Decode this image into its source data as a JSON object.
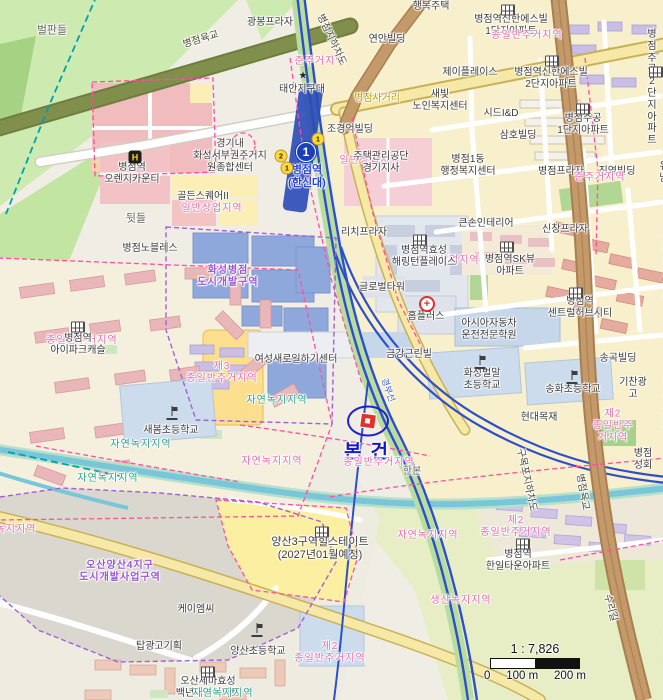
{
  "map": {
    "subject": {
      "label": "본건"
    },
    "station": {
      "line": "1",
      "name": "병점역",
      "name_sub": "(한신대)"
    },
    "scale": {
      "ratio": "1 : 7,826",
      "ticks": [
        "0",
        "100 m",
        "200 m"
      ]
    },
    "colors": {
      "subject_blue": "#2121c9",
      "subject_red": "#e43028",
      "zone_pink": "#e66cab",
      "zone_green": "#2ba187",
      "zone_purple": "#9a55d2",
      "railway_blue": "#2d4fc8",
      "road_brown": "#c59a6b",
      "road_olive": "#808f4c",
      "field_green": "#cdebb0",
      "urban_yellow": "#f8f0cc",
      "water": "#79c6db",
      "line1_badge": "#1b3fb5"
    },
    "labels": [
      {
        "t": "벌판들",
        "x": 52,
        "y": 31,
        "c": "g",
        "s": 11
      },
      {
        "t": "광봉프라자",
        "x": 270,
        "y": 23,
        "c": "b"
      },
      {
        "t": "행복주택",
        "x": 431,
        "y": 7,
        "c": "b"
      },
      {
        "t": "병점역신한에스빌\n1단지아파트",
        "x": 511,
        "y": 26,
        "c": "b"
      },
      {
        "t": "종일반주거지역",
        "x": 527,
        "y": 36,
        "c": "zp"
      },
      {
        "t": "연안빌딩",
        "x": 387,
        "y": 40,
        "c": "b"
      },
      {
        "t": "준주거지역",
        "x": 320,
        "y": 62,
        "c": "zp"
      },
      {
        "t": "준주거지역",
        "x": 668,
        "y": 59,
        "c": "zp"
      },
      {
        "t": "제이플레이스",
        "x": 470,
        "y": 73,
        "c": "b"
      },
      {
        "t": "병점역신한에스빌\n2단지아파트",
        "x": 551,
        "y": 79,
        "c": "b"
      },
      {
        "t": "병점주공\n2단지아파트",
        "x": 652,
        "y": 88,
        "c": "b"
      },
      {
        "t": "새빛\n노인복지센터",
        "x": 440,
        "y": 101,
        "c": "b"
      },
      {
        "t": "시드I&D",
        "x": 501,
        "y": 114,
        "c": "b"
      },
      {
        "t": "삼호빌딩",
        "x": 518,
        "y": 136,
        "c": "b"
      },
      {
        "t": "병점주공\n1단지아파트",
        "x": 583,
        "y": 125,
        "c": "b"
      },
      {
        "t": "태안지구대",
        "x": 302,
        "y": 90,
        "c": "b"
      },
      {
        "t": "병점사거리",
        "x": 377,
        "y": 99,
        "c": "yj"
      },
      {
        "t": "조경억빌딩",
        "x": 350,
        "y": 130,
        "c": "b"
      },
      {
        "t": "경기내\n화성서부권주거지\n원종합센터",
        "x": 230,
        "y": 156,
        "c": "b"
      },
      {
        "t": "병점역\n오렌지카운티",
        "x": 132,
        "y": 174,
        "c": "b"
      },
      {
        "t": "일반상업지역",
        "x": 370,
        "y": 161,
        "c": "zp"
      },
      {
        "t": "주택관리공단\n경기지사",
        "x": 381,
        "y": 163,
        "c": "b"
      },
      {
        "t": "병점1동\n행정복지센터",
        "x": 468,
        "y": 166,
        "c": "b"
      },
      {
        "t": "병점프라자",
        "x": 561,
        "y": 172,
        "c": "b"
      },
      {
        "t": "진영빌딩",
        "x": 617,
        "y": 172,
        "c": "b"
      },
      {
        "t": "준주거지역",
        "x": 600,
        "y": 178,
        "c": "zp"
      },
      {
        "t": "유남",
        "x": 664,
        "y": 173,
        "c": "b"
      },
      {
        "t": "골든스퀘어II",
        "x": 203,
        "y": 197,
        "c": "b"
      },
      {
        "t": "일반상업지역",
        "x": 212,
        "y": 209,
        "c": "zp"
      },
      {
        "t": "뒷들",
        "x": 136,
        "y": 219,
        "c": "g",
        "s": 11
      },
      {
        "t": "리치프라자",
        "x": 364,
        "y": 233,
        "c": "b"
      },
      {
        "t": "큰손인테리어",
        "x": 486,
        "y": 224,
        "c": "b"
      },
      {
        "t": "신창프라자",
        "x": 565,
        "y": 230,
        "c": "b"
      },
      {
        "t": "병점노블레스",
        "x": 150,
        "y": 249,
        "c": "b"
      },
      {
        "t": "제3\n종일반주거지역",
        "x": 672,
        "y": 233,
        "c": "zp"
      },
      {
        "t": "자연녹지지역",
        "x": 668,
        "y": 271,
        "c": "zg"
      },
      {
        "t": "일반상업지역",
        "x": 449,
        "y": 261,
        "c": "zp"
      },
      {
        "t": "병점역효성\n해링턴플레이스",
        "x": 424,
        "y": 257,
        "c": "b"
      },
      {
        "t": "병점역SK뷰\n아파트",
        "x": 510,
        "y": 266,
        "c": "b"
      },
      {
        "t": "남수원",
        "x": 668,
        "y": 262,
        "c": "b"
      },
      {
        "t": "글로벌타워",
        "x": 382,
        "y": 288,
        "c": "b"
      },
      {
        "t": "병점역\n센트럴허브시티",
        "x": 580,
        "y": 308,
        "c": "b"
      },
      {
        "t": "홈플러스",
        "x": 426,
        "y": 317,
        "c": "b"
      },
      {
        "t": "아시아자동차\n운전전문학원",
        "x": 489,
        "y": 330,
        "c": "b"
      },
      {
        "t": "송곡빌딩",
        "x": 618,
        "y": 359,
        "c": "b"
      },
      {
        "t": "기찬광고",
        "x": 633,
        "y": 389,
        "c": "b"
      },
      {
        "t": "금강근린빌",
        "x": 409,
        "y": 355,
        "c": "b"
      },
      {
        "t": "화성벌말\n초등학교",
        "x": 482,
        "y": 380,
        "c": "b"
      },
      {
        "t": "송화초등학교",
        "x": 573,
        "y": 390,
        "c": "b"
      },
      {
        "t": "현대목재",
        "x": 539,
        "y": 418,
        "c": "b"
      },
      {
        "t": "여성새로일하기센터",
        "x": 296,
        "y": 360,
        "c": "b"
      },
      {
        "t": "제3\n종일반주거지역",
        "x": 222,
        "y": 373,
        "c": "zp"
      },
      {
        "t": "자연녹지지역",
        "x": 277,
        "y": 401,
        "c": "zg"
      },
      {
        "t": "종일반주거지역",
        "x": 82,
        "y": 341,
        "c": "zp"
      },
      {
        "t": "병점역\n아이파크캐슬",
        "x": 78,
        "y": 345,
        "c": "b"
      },
      {
        "t": "새봄초등학교",
        "x": 171,
        "y": 431,
        "c": "b"
      },
      {
        "t": "자연녹지지역",
        "x": 141,
        "y": 445,
        "c": "zg"
      },
      {
        "t": "자연녹지지역",
        "x": 108,
        "y": 479,
        "c": "zg"
      },
      {
        "t": "자연녹지지역",
        "x": 272,
        "y": 462,
        "c": "zp"
      },
      {
        "t": "화성병점\n도시개발구역",
        "x": 228,
        "y": 277,
        "c": "zv"
      },
      {
        "t": "병점성회",
        "x": 643,
        "y": 460,
        "c": "b"
      },
      {
        "t": "준주거지역",
        "x": 668,
        "y": 408,
        "c": "zp"
      },
      {
        "t": "종일반주거지역",
        "x": 379,
        "y": 463,
        "c": "zp"
      },
      {
        "t": "한본",
        "x": 412,
        "y": 472,
        "c": "g"
      },
      {
        "t": "구목포지하차도",
        "x": 526,
        "y": 480,
        "c": "rd",
        "r": 78
      },
      {
        "t": "병점육교",
        "x": 582,
        "y": 492,
        "c": "rd",
        "r": 80
      },
      {
        "t": "병점육교",
        "x": 201,
        "y": 40,
        "c": "rd",
        "r": -17
      },
      {
        "t": "병점지하차도",
        "x": 331,
        "y": 40,
        "c": "rd",
        "r": 65
      },
      {
        "t": "경부선",
        "x": 388,
        "y": 390,
        "c": "rb",
        "r": 70
      },
      {
        "t": "돌봄누리\n송회지역아동센터",
        "x": 678,
        "y": 506,
        "c": "b"
      },
      {
        "t": "종일반주거지역",
        "x": 688,
        "y": 566,
        "c": "zp"
      },
      {
        "t": "제2\n종일반주거지역",
        "x": 613,
        "y": 426,
        "c": "zp"
      },
      {
        "t": "제2\n종일반주거지역",
        "x": 516,
        "y": 527,
        "c": "zp"
      },
      {
        "t": "병점역\n한일타운아파트",
        "x": 518,
        "y": 561,
        "c": "b"
      },
      {
        "t": "자연녹지지역",
        "x": 428,
        "y": 536,
        "c": "zp"
      },
      {
        "t": "생산녹지지역",
        "x": 461,
        "y": 601,
        "c": "zp"
      },
      {
        "t": "양산3구역힐스테이트\n(2027년01월예정)",
        "x": 320,
        "y": 549,
        "c": "b",
        "s": 11
      },
      {
        "t": "오산양산4지구\n도시개발사업구역",
        "x": 120,
        "y": 572,
        "c": "zv"
      },
      {
        "t": "케이엠씨",
        "x": 196,
        "y": 610,
        "c": "b"
      },
      {
        "t": "탑광고기획",
        "x": 159,
        "y": 647,
        "c": "b"
      },
      {
        "t": "양산초등학교",
        "x": 258,
        "y": 652,
        "c": "b"
      },
      {
        "t": "제2\n종일반주거지역",
        "x": 330,
        "y": 653,
        "c": "zp"
      },
      {
        "t": "오산세마효성\n백년가약아파트",
        "x": 208,
        "y": 688,
        "c": "b"
      },
      {
        "t": "자연녹지지역",
        "x": 223,
        "y": 694,
        "c": "zg"
      },
      {
        "t": "수리길",
        "x": 610,
        "y": 608,
        "c": "rd",
        "r": 75
      },
      {
        "t": "태조로",
        "x": 668,
        "y": 646,
        "c": "g"
      },
      {
        "t": "녹지지역",
        "x": 16,
        "y": 530,
        "c": "zp"
      }
    ],
    "icons": [
      {
        "type": "apartment",
        "x": 508,
        "y": 10
      },
      {
        "type": "apartment",
        "x": 552,
        "y": 61
      },
      {
        "type": "apartment",
        "x": 656,
        "y": 72
      },
      {
        "type": "apartment",
        "x": 583,
        "y": 109
      },
      {
        "type": "apartment",
        "x": 420,
        "y": 240
      },
      {
        "type": "apartment",
        "x": 507,
        "y": 247
      },
      {
        "type": "apartment",
        "x": 576,
        "y": 293
      },
      {
        "type": "apartment",
        "x": 78,
        "y": 327
      },
      {
        "type": "apartment",
        "x": 322,
        "y": 532
      },
      {
        "type": "apartment",
        "x": 523,
        "y": 544
      },
      {
        "type": "apartment",
        "x": 208,
        "y": 672
      },
      {
        "type": "school",
        "x": 172,
        "y": 413
      },
      {
        "type": "school",
        "x": 480,
        "y": 362
      },
      {
        "type": "school",
        "x": 572,
        "y": 377
      },
      {
        "type": "school",
        "x": 257,
        "y": 630
      },
      {
        "type": "hotel",
        "x": 135,
        "y": 157,
        "glyph": "H"
      },
      {
        "type": "police",
        "x": 303,
        "y": 76,
        "glyph": "★"
      },
      {
        "type": "homeplus",
        "x": 427,
        "y": 304,
        "glyph": "+"
      },
      {
        "type": "line1-badge",
        "x": 306,
        "y": 152,
        "glyph": "1"
      },
      {
        "type": "exit-badge",
        "x": 318,
        "y": 139,
        "glyph": "1"
      },
      {
        "type": "exit-badge",
        "x": 281,
        "y": 156,
        "glyph": "2"
      },
      {
        "type": "exit-badge",
        "x": 287,
        "y": 168,
        "glyph": "1"
      }
    ]
  }
}
